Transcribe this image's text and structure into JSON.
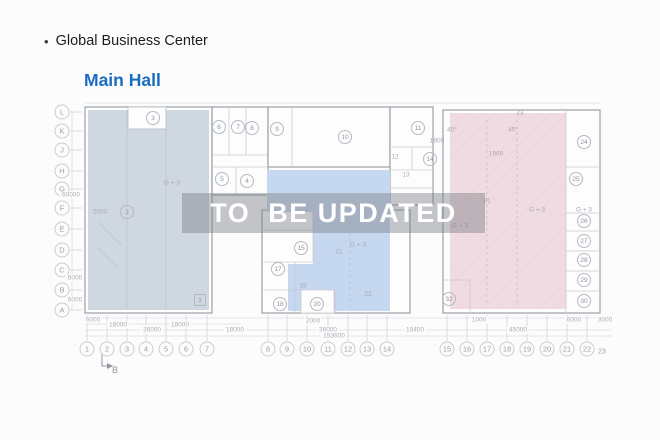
{
  "header": {
    "bullet": "•",
    "title": "Global Business Center",
    "subtitle": "Main Hall"
  },
  "watermark": {
    "text": "TO  BE UPDATED"
  },
  "colors": {
    "title_color": "#1d1d1f",
    "subtitle_blue": "#1a6cc2",
    "left_region": "#cfd7e0",
    "middle_region": "#c6d7f0",
    "right_region": "#f0dbe1",
    "wall": "#9aa1a9",
    "inner_line": "#c7cbd0",
    "dim_line": "#d9dbdf",
    "watermark_band": "rgba(124,128,136,0.45)",
    "watermark_text": "#ffffff"
  },
  "plan": {
    "rooms": [
      {
        "n": "1",
        "x": 200,
        "y": 300,
        "square": true
      },
      {
        "n": "2",
        "x": 127,
        "y": 212
      },
      {
        "n": "3",
        "x": 153,
        "y": 118
      },
      {
        "n": "4",
        "x": 247,
        "y": 181
      },
      {
        "n": "5",
        "x": 222,
        "y": 179
      },
      {
        "n": "6",
        "x": 219,
        "y": 127
      },
      {
        "n": "7",
        "x": 238,
        "y": 127
      },
      {
        "n": "8",
        "x": 252,
        "y": 128
      },
      {
        "n": "9",
        "x": 277,
        "y": 129
      },
      {
        "n": "10",
        "x": 345,
        "y": 137
      },
      {
        "n": "11",
        "x": 418,
        "y": 128
      },
      {
        "n": "14",
        "x": 430,
        "y": 159
      },
      {
        "n": "15",
        "x": 301,
        "y": 248
      },
      {
        "n": "17",
        "x": 278,
        "y": 269
      },
      {
        "n": "18",
        "x": 280,
        "y": 304
      },
      {
        "n": "20",
        "x": 317,
        "y": 304
      },
      {
        "n": "24",
        "x": 584,
        "y": 142
      },
      {
        "n": "25",
        "x": 576,
        "y": 179
      },
      {
        "n": "26",
        "x": 584,
        "y": 221
      },
      {
        "n": "27",
        "x": 584,
        "y": 241
      },
      {
        "n": "28",
        "x": 584,
        "y": 260
      },
      {
        "n": "29",
        "x": 584,
        "y": 280
      },
      {
        "n": "30",
        "x": 584,
        "y": 301
      },
      {
        "n": "32",
        "x": 449,
        "y": 299
      }
    ],
    "labels": [
      {
        "t": "12",
        "x": 395,
        "y": 157
      },
      {
        "t": "13",
        "x": 406,
        "y": 175
      },
      {
        "t": "19",
        "x": 303,
        "y": 286
      },
      {
        "t": "21",
        "x": 339,
        "y": 252
      },
      {
        "t": "22",
        "x": 368,
        "y": 294
      },
      {
        "t": "23",
        "x": 520,
        "y": 113
      },
      {
        "t": "31",
        "x": 487,
        "y": 201
      },
      {
        "t": "G + 3",
        "x": 172,
        "y": 183
      },
      {
        "t": "G + 3",
        "x": 358,
        "y": 245
      },
      {
        "t": "G + 3",
        "x": 537,
        "y": 210
      },
      {
        "t": "G + 3",
        "x": 460,
        "y": 226
      },
      {
        "t": "G + 3",
        "x": 584,
        "y": 210
      },
      {
        "t": "45°",
        "x": 452,
        "y": 130
      },
      {
        "t": "45°",
        "x": 513,
        "y": 130
      },
      {
        "t": "1900",
        "x": 496,
        "y": 154
      },
      {
        "t": "1900",
        "x": 437,
        "y": 141
      },
      {
        "t": "2000",
        "x": 100,
        "y": 212
      }
    ],
    "row_axis": [
      {
        "label": "L",
        "y": 112
      },
      {
        "label": "K",
        "y": 131
      },
      {
        "label": "J",
        "y": 150
      },
      {
        "label": "H",
        "y": 171
      },
      {
        "label": "G",
        "y": 189
      },
      {
        "label": "F",
        "y": 208
      },
      {
        "label": "E",
        "y": 229
      },
      {
        "label": "D",
        "y": 250
      },
      {
        "label": "C",
        "y": 270
      },
      {
        "label": "B",
        "y": 290
      },
      {
        "label": "A",
        "y": 310
      }
    ],
    "col_axis": [
      {
        "label": "1",
        "x": 87
      },
      {
        "label": "2",
        "x": 107
      },
      {
        "label": "3",
        "x": 127
      },
      {
        "label": "4",
        "x": 146
      },
      {
        "label": "5",
        "x": 166
      },
      {
        "label": "6",
        "x": 186
      },
      {
        "label": "7",
        "x": 207
      },
      {
        "label": "8",
        "x": 268
      },
      {
        "label": "9",
        "x": 287
      },
      {
        "label": "10",
        "x": 307
      },
      {
        "label": "11",
        "x": 328
      },
      {
        "label": "12",
        "x": 348
      },
      {
        "label": "13",
        "x": 367
      },
      {
        "label": "14",
        "x": 387
      },
      {
        "label": "15",
        "x": 447
      },
      {
        "label": "16",
        "x": 467
      },
      {
        "label": "17",
        "x": 487
      },
      {
        "label": "18",
        "x": 507
      },
      {
        "label": "19",
        "x": 527
      },
      {
        "label": "20",
        "x": 547
      },
      {
        "label": "21",
        "x": 567
      },
      {
        "label": "22",
        "x": 587
      },
      {
        "label": "23",
        "x": 602,
        "y": 352,
        "plain": true
      }
    ],
    "dims_h": [
      {
        "t": "6000",
        "x": 93,
        "y": 320
      },
      {
        "t": "2000",
        "x": 313,
        "y": 321
      },
      {
        "t": "1000",
        "x": 479,
        "y": 320
      },
      {
        "t": "6000",
        "x": 574,
        "y": 320
      },
      {
        "t": "3000",
        "x": 605,
        "y": 320
      },
      {
        "t": "18000",
        "x": 118,
        "y": 325
      },
      {
        "t": "18000",
        "x": 180,
        "y": 325
      },
      {
        "t": "36000",
        "x": 152,
        "y": 330
      },
      {
        "t": "18000",
        "x": 235,
        "y": 330
      },
      {
        "t": "36000",
        "x": 328,
        "y": 330
      },
      {
        "t": "18400",
        "x": 415,
        "y": 330
      },
      {
        "t": "45000",
        "x": 518,
        "y": 330
      },
      {
        "t": "153600",
        "x": 334,
        "y": 336
      }
    ],
    "dims_v": [
      {
        "t": "60000",
        "x": 71,
        "y": 195
      },
      {
        "t": "6000",
        "x": 75,
        "y": 278
      },
      {
        "t": "6000",
        "x": 75,
        "y": 300
      }
    ],
    "section_marker": {
      "label": "B",
      "x": 115,
      "y": 370
    }
  }
}
